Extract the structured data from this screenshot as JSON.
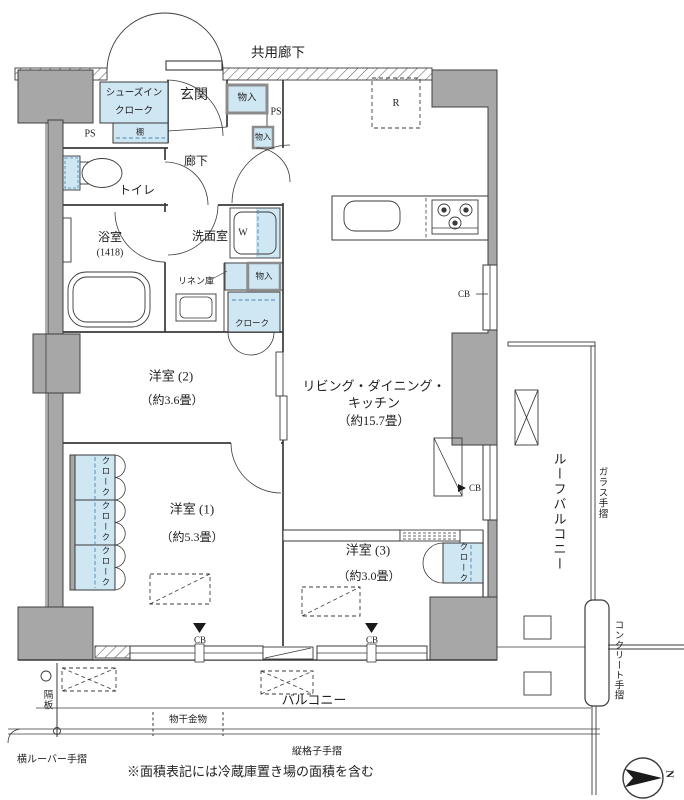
{
  "title": "共用廊下",
  "entrance": {
    "genkan": "玄関",
    "shoes_closet_line1": "シューズイン",
    "shoes_closet_line2": "クローク",
    "shelf": "棚",
    "storage": "物入",
    "storage_small": "物入",
    "ps": "PS",
    "hallway": "廊下"
  },
  "water": {
    "toilet": "トイレ",
    "bath": "浴室",
    "bath_size": "(1418)",
    "washroom": "洗面室",
    "washer": "W",
    "linen": "リネン庫",
    "storage": "物入",
    "closet": "クローク"
  },
  "rooms": {
    "room2_name": "洋室 (2)",
    "room2_size": "（約3.6畳）",
    "ldk_line1": "リビング・ダイニング・",
    "ldk_line2": "キッチン",
    "ldk_size": "（約15.7畳）",
    "room1_name": "洋室 (1)",
    "room1_size": "（約5.3畳）",
    "room3_name": "洋室 (3)",
    "room3_size": "（約3.0畳）",
    "closet": "クローク",
    "fridge": "R"
  },
  "marker_cb": "CB",
  "outdoor": {
    "roof_balcony": "ルーフバルコニー",
    "glass_rail": "ガラス手摺",
    "concrete_rail": "コンクリート手摺",
    "partition": "隔板",
    "balcony": "バルコニー",
    "laundry_bracket": "物干金物",
    "louver_rail": "横ルーバー手摺",
    "lattice_rail": "縦格子手摺"
  },
  "note": "※面積表記には冷蔵庫置き場の面積を含む",
  "compass": "N",
  "colors": {
    "wall": "#a7a7a7",
    "fixture_blue": "#cfe6f3",
    "line": "#3a3a3a"
  }
}
